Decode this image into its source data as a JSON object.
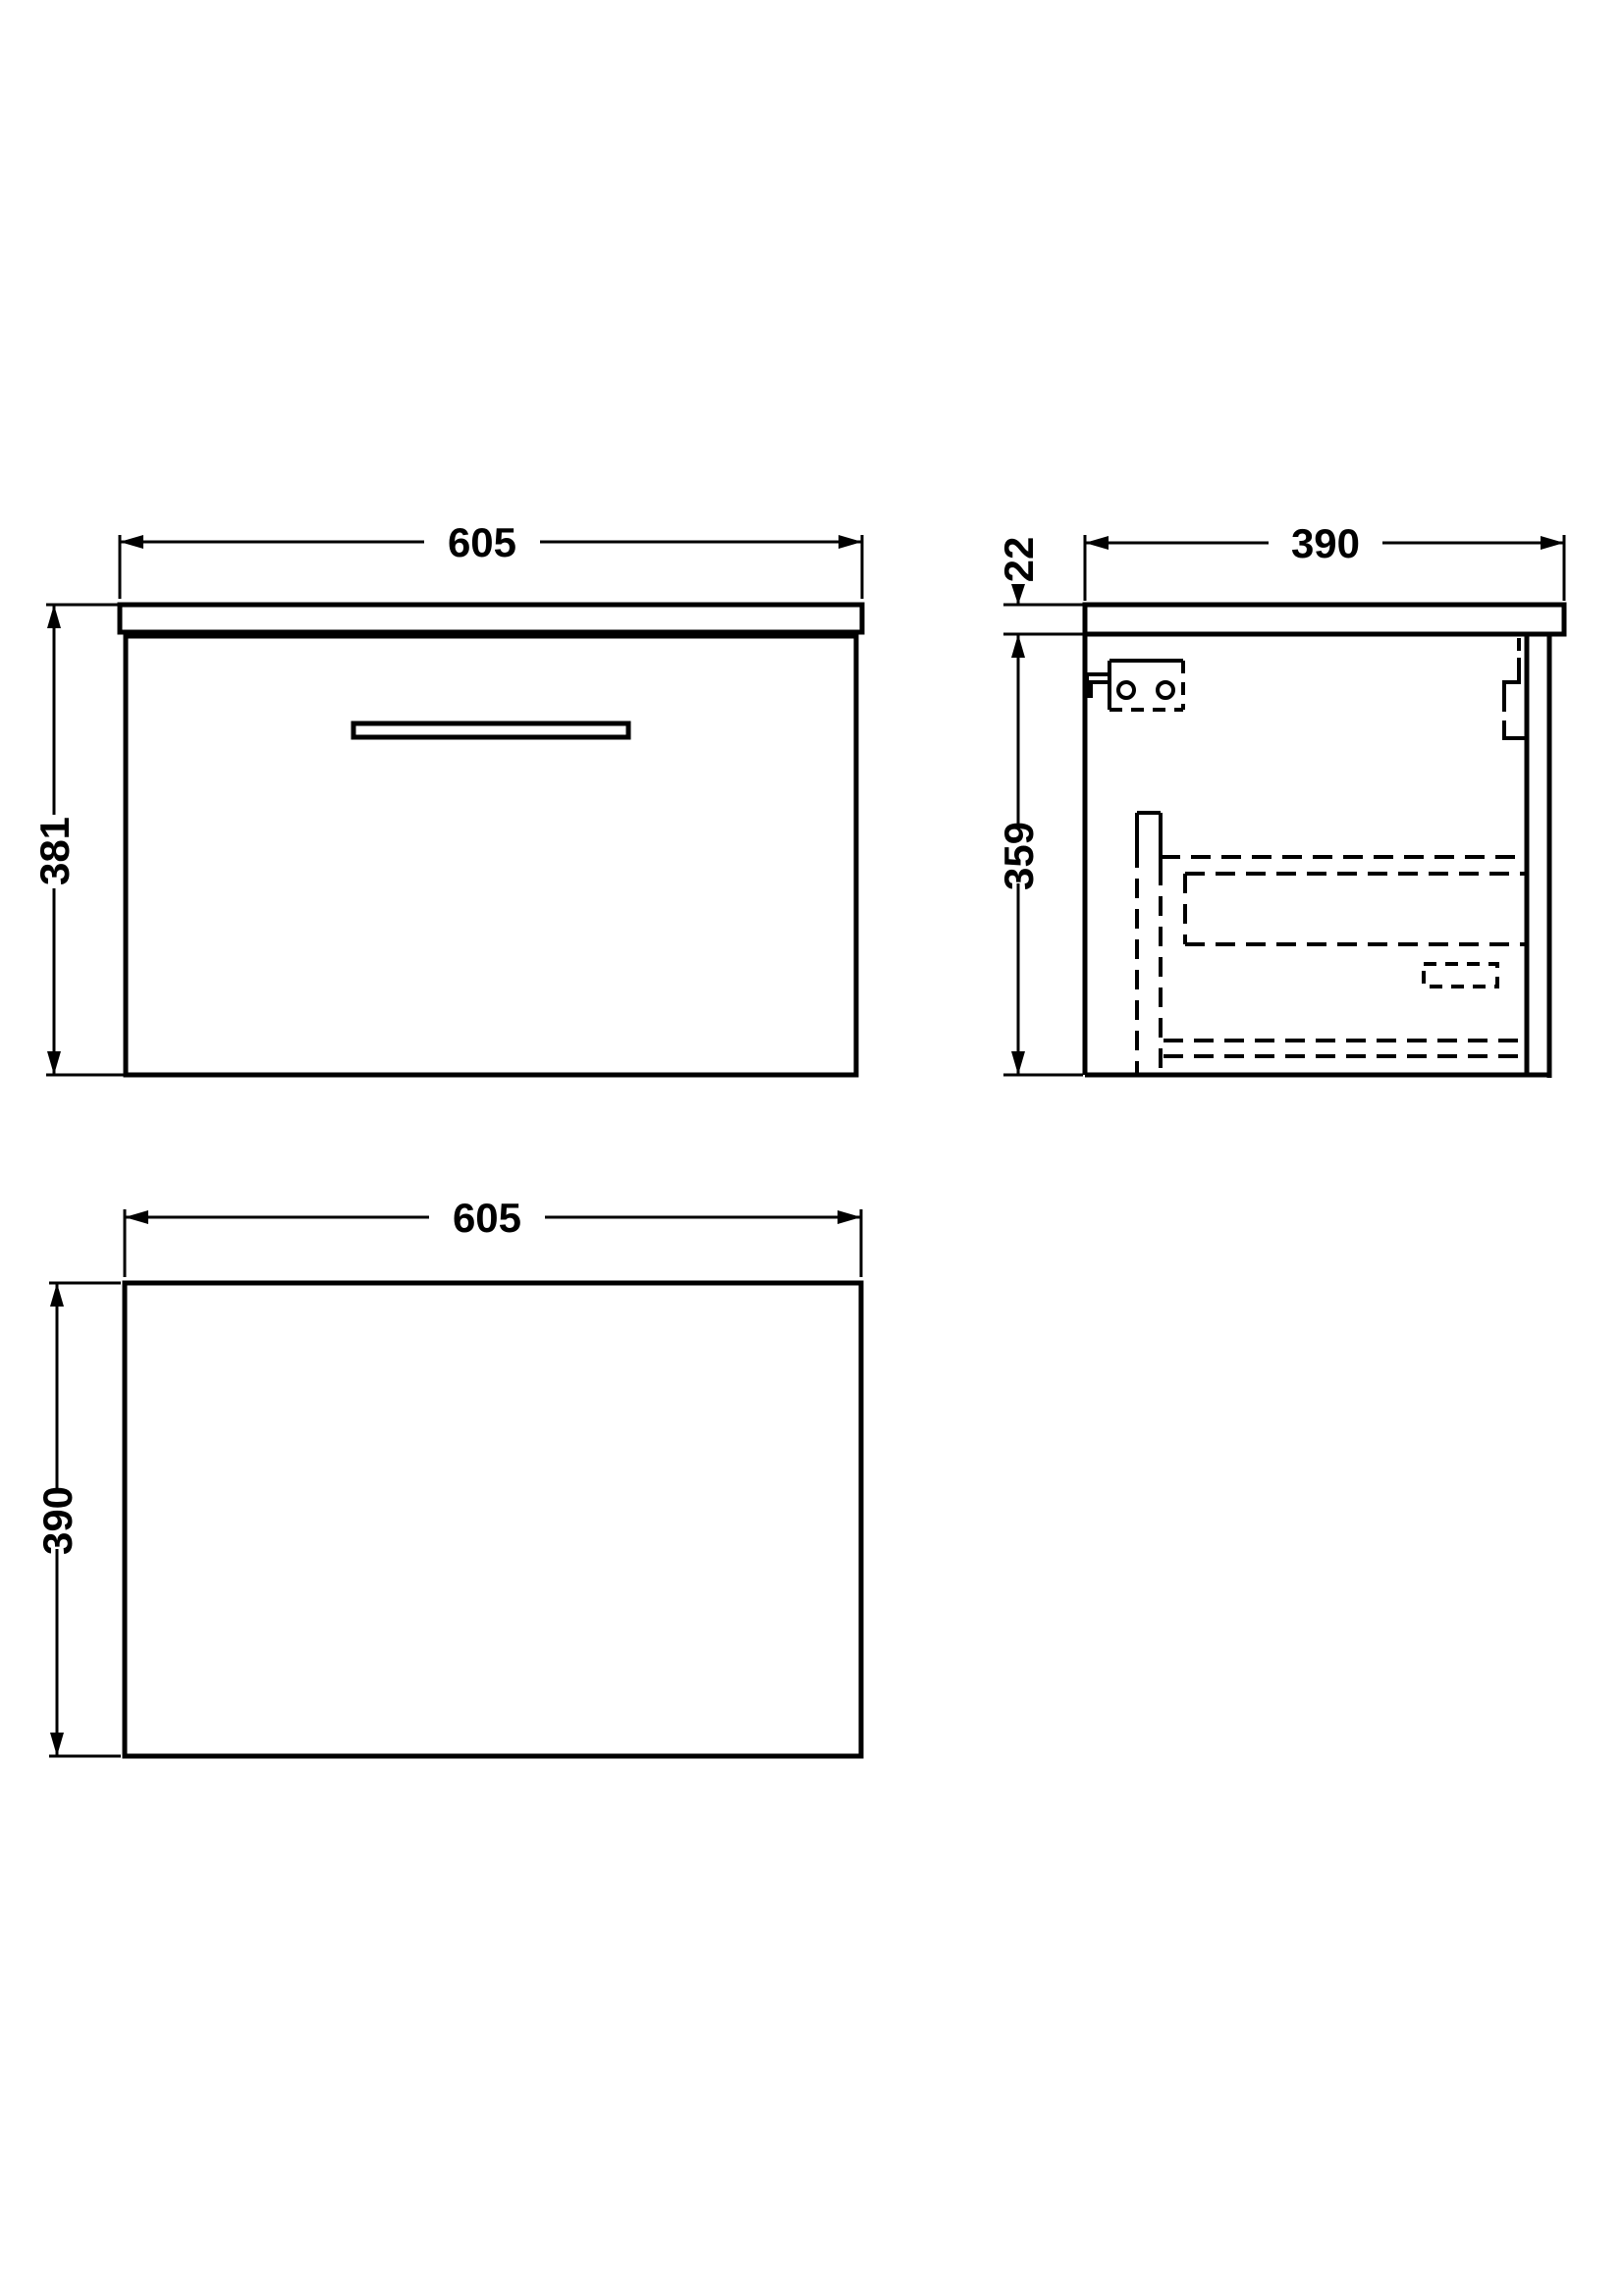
{
  "drawing_title": "wall-hung vanity unit technical drawing",
  "colors": {
    "line": "#000000",
    "background": "#ffffff"
  },
  "views": {
    "front": {
      "width_label": "605",
      "height_label": "381"
    },
    "side": {
      "depth_label": "390",
      "worktop_thickness_label": "22",
      "body_height_label": "359"
    },
    "plan": {
      "width_label": "605",
      "depth_label": "390"
    }
  }
}
